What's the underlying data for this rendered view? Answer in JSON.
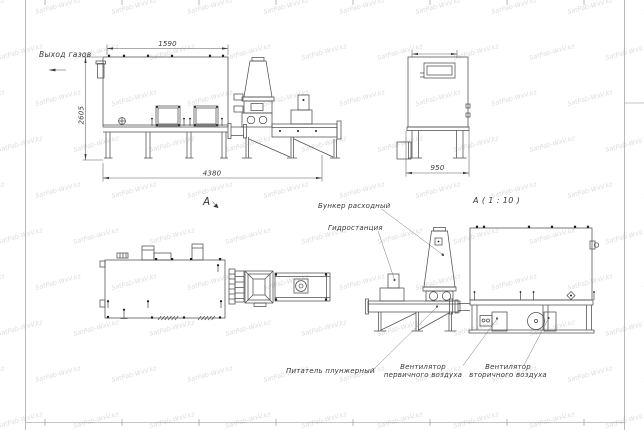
{
  "sheet": {
    "watermark_text": "SatPab-WxV.kz",
    "watermark_color": "#dcdcdc",
    "background": "#ffffff",
    "line_color": "#4f4f4f",
    "text_color": "#383838"
  },
  "side_view": {
    "gas_outlet_label": "Выход газов",
    "dim_top": "1590",
    "dim_left": "2605",
    "dim_bottom": "4380",
    "view_label": "А"
  },
  "end_view": {
    "dim_bottom": "950"
  },
  "detail_view": {
    "title": "А ( 1 : 10 )",
    "callout_hopper": "Бункер расходный",
    "callout_hydraulic": "Гидростанция",
    "callout_feeder": "Питатель плунжерный",
    "callout_primary_fan_l1": "Вентилятор",
    "callout_primary_fan_l2": "первичного воздуха",
    "callout_secondary_fan_l1": "Вентилятор",
    "callout_secondary_fan_l2": "вторичного воздуха"
  }
}
